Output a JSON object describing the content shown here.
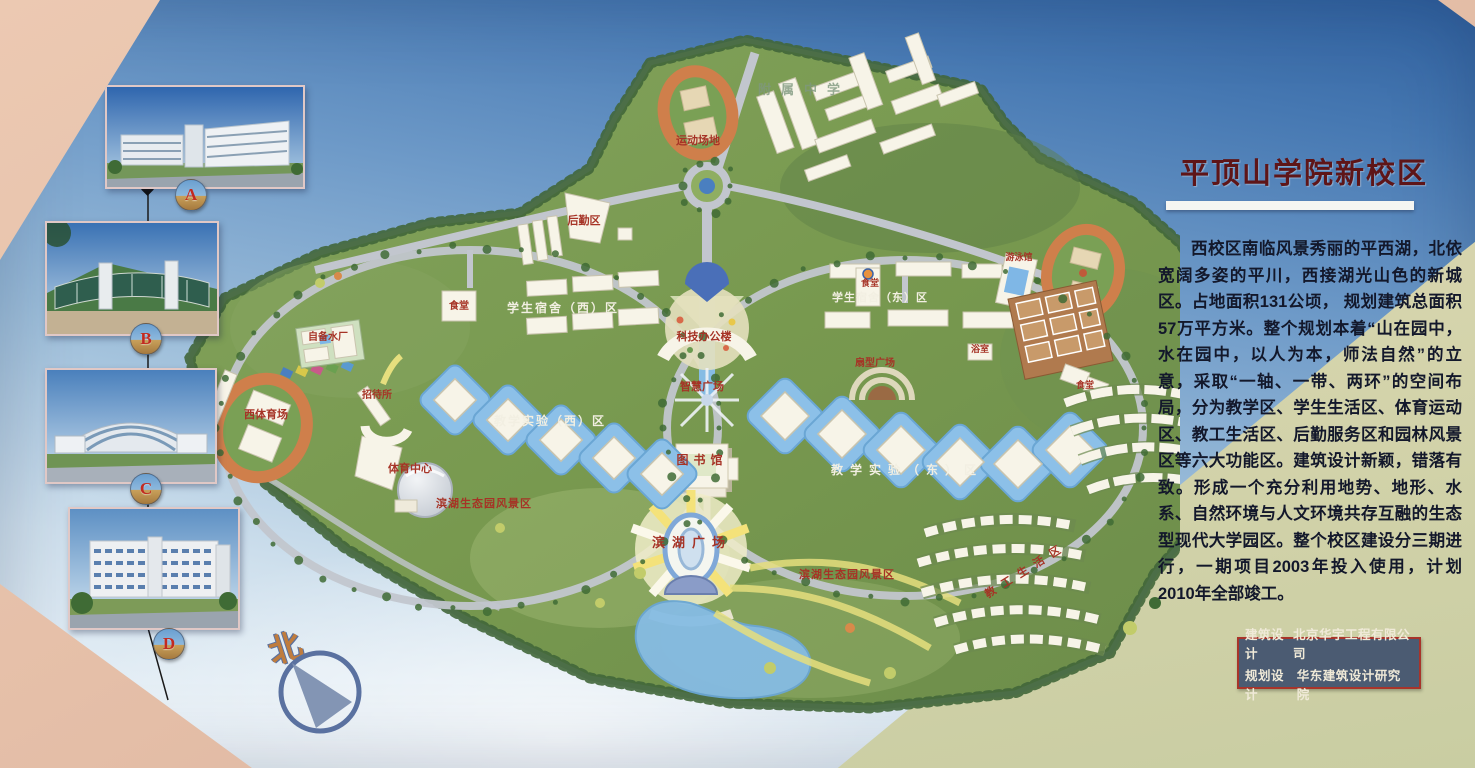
{
  "title": "平顶山学院新校区",
  "description": "西校区南临风景秀丽的平西湖，北依宽阔多姿的平川，西接湖光山色的新城区。占地面积131公顷， 规划建筑总面积57万平方米。整个规划本着“山在园中，水在园中，以人为本，师法自然”的立意，采取“一轴、一带、两环”的空间布局，分为教学区、学生生活区、体育运动区、教工生活区、后勤服务区和园林风景区等六大功能区。建筑设计新颖，错落有致。形成一个充分利用地势、地形、水系、自然环境与人文环境共存互融的生态型现代大学园区。整个校区建设分三期进行，一期项目2003年投入使用，计划2010年全部竣工。",
  "credits": {
    "rows": [
      {
        "label": "建筑设计",
        "value": "北京华宇工程有限公司"
      },
      {
        "label": "规划设计",
        "value": "华东建筑设计研究院"
      }
    ]
  },
  "compass_label": "北",
  "photos": [
    {
      "letter": "A"
    },
    {
      "letter": "B"
    },
    {
      "letter": "C"
    },
    {
      "letter": "D"
    }
  ],
  "colors": {
    "title": "#5e1518",
    "credits_bg": "#4b5b72",
    "credits_border": "#a8342a",
    "map_label_red": "#a63326",
    "map_label_white": "#f2efe2",
    "track_orange": "#cf7f4b",
    "water_blue": "#86bce4",
    "building_white": "#f7f4e8",
    "campus_green": "#7d9b58",
    "wall_pink": "#e5bfa8",
    "panel_cream": "#d5d4ac"
  },
  "map_labels": [
    {
      "t": "运动场地",
      "x": 528,
      "y": 116,
      "c": "red",
      "s": 11
    },
    {
      "t": "附属中学",
      "x": 634,
      "y": 66,
      "c": "faint",
      "s": 13,
      "ls": 10
    },
    {
      "t": "后勤区",
      "x": 414,
      "y": 196,
      "c": "red",
      "s": 11
    },
    {
      "t": "食堂",
      "x": 289,
      "y": 281,
      "c": "red",
      "s": 10
    },
    {
      "t": "学生宿舍（西）区",
      "x": 393,
      "y": 284,
      "c": "white",
      "s": 12,
      "ls": 2
    },
    {
      "t": "自备水厂",
      "x": 158,
      "y": 312,
      "c": "red",
      "s": 10
    },
    {
      "t": "招待所",
      "x": 207,
      "y": 370,
      "c": "red",
      "s": 10
    },
    {
      "t": "西体育场",
      "x": 96,
      "y": 390,
      "c": "red",
      "s": 11
    },
    {
      "t": "体育中心",
      "x": 240,
      "y": 444,
      "c": "red",
      "s": 11
    },
    {
      "t": "科技办公楼",
      "x": 534,
      "y": 312,
      "c": "red",
      "s": 11
    },
    {
      "t": "智慧广场",
      "x": 532,
      "y": 362,
      "c": "red",
      "s": 11
    },
    {
      "t": "图书馆",
      "x": 532,
      "y": 436,
      "c": "red",
      "s": 12,
      "ls": 5
    },
    {
      "t": "滨湖广场",
      "x": 522,
      "y": 519,
      "c": "red",
      "s": 13,
      "ls": 7
    },
    {
      "t": "教学实验（西）区",
      "x": 380,
      "y": 397,
      "c": "white",
      "s": 12,
      "ls": 2
    },
    {
      "t": "教学实验（东）区",
      "x": 737,
      "y": 446,
      "c": "white",
      "s": 12,
      "ls": 7
    },
    {
      "t": "滨湖生态园风景区",
      "x": 314,
      "y": 479,
      "c": "red",
      "s": 11,
      "ls": 1
    },
    {
      "t": "滨湖生态园风景区",
      "x": 677,
      "y": 550,
      "c": "red",
      "s": 11,
      "ls": 1
    },
    {
      "t": "学生宿舍（东）区",
      "x": 710,
      "y": 273,
      "c": "white",
      "s": 11,
      "ls": 1
    },
    {
      "t": "食堂",
      "x": 700,
      "y": 258,
      "c": "red",
      "s": 9
    },
    {
      "t": "游泳馆",
      "x": 849,
      "y": 232,
      "c": "red",
      "s": 9
    },
    {
      "t": "浴室",
      "x": 810,
      "y": 324,
      "c": "red",
      "s": 9
    },
    {
      "t": "扇型广场",
      "x": 705,
      "y": 338,
      "c": "red",
      "s": 10
    },
    {
      "t": "食堂",
      "x": 915,
      "y": 360,
      "c": "red",
      "s": 9
    },
    {
      "t": "教工生活区",
      "x": 858,
      "y": 545,
      "c": "red",
      "s": 11,
      "ls": 8,
      "r": -32
    }
  ]
}
